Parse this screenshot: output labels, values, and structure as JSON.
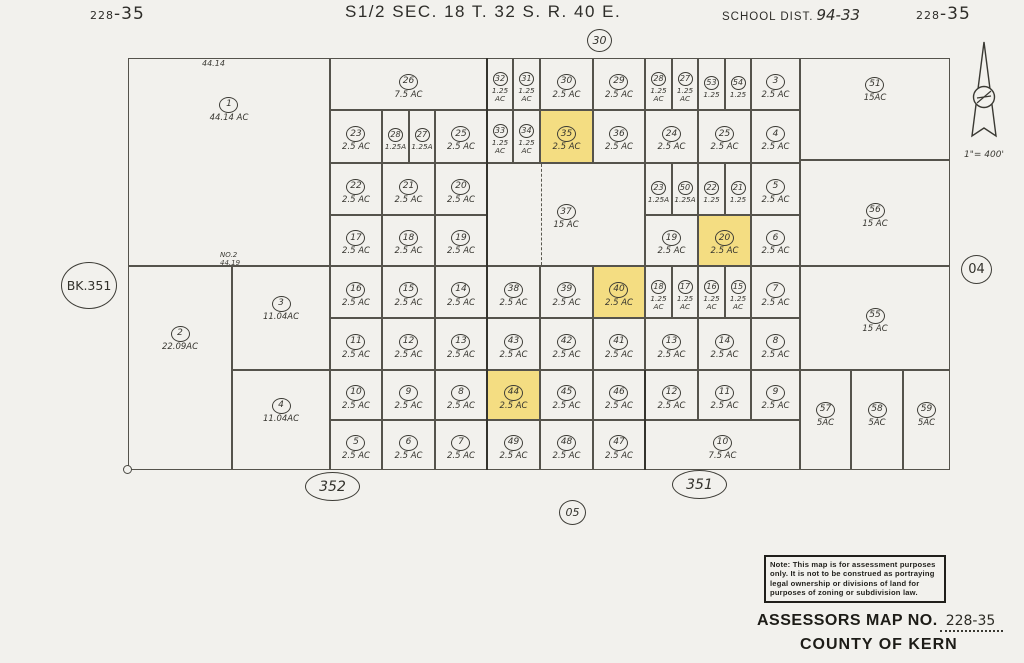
{
  "header": {
    "left_book": "228",
    "left_page": "-35",
    "title": "S1/2  SEC. 18  T. 32 S.  R. 40 E.",
    "school_label": "SCHOOL DIST.",
    "school_value": "94-33",
    "right_book": "228",
    "right_page": "-35"
  },
  "markers": {
    "section_top": "30",
    "section_bottom": "05",
    "section_right": "04",
    "book_left": "BK.351",
    "page_bottom_left": "352",
    "page_bottom_right": "351"
  },
  "edge_labels": {
    "top_dimension": "44.14",
    "road_name": "NO.2",
    "road_dimension": "44.19"
  },
  "scale_text": "1\"= 400'",
  "note_box": {
    "lines": [
      "Note: This map is for assessment purposes",
      "only. It is not to be construed as portraying",
      "legal ownership or divisions of land for",
      "purposes of zoning or subdivision law."
    ]
  },
  "footer": {
    "assessors_label": "ASSESSORS MAP NO.",
    "assessors_value": "228-35",
    "county": "COUNTY OF KERN"
  },
  "map": {
    "highlight_color": "#f4dd82",
    "parcels": [
      {
        "n": "1",
        "a": "44.14 AC",
        "x": 128,
        "y": 58,
        "w": 202,
        "h": 208,
        "dy": -55
      },
      {
        "n": "2",
        "a": "22.09AC",
        "x": 128,
        "y": 266,
        "w": 104,
        "h": 204,
        "dy": -32
      },
      {
        "n": "3",
        "a": "11.04AC",
        "x": 232,
        "y": 266,
        "w": 98,
        "h": 104,
        "dy": -12
      },
      {
        "n": "4",
        "a": "11.04AC",
        "x": 232,
        "y": 370,
        "w": 98,
        "h": 100,
        "dy": -12
      },
      {
        "n": "26",
        "a": "7.5 AC",
        "x": 330,
        "y": 58,
        "w": 157,
        "h": 52
      },
      {
        "n": "23",
        "a": "2.5 AC",
        "x": 330,
        "y": 110,
        "w": 52,
        "h": 53
      },
      {
        "n": "28",
        "a": "1.25A",
        "x": 382,
        "y": 110,
        "w": 27,
        "h": 53
      },
      {
        "n": "27",
        "a": "1.25A",
        "x": 409,
        "y": 110,
        "w": 26,
        "h": 53
      },
      {
        "n": "25",
        "a": "2.5 AC",
        "x": 435,
        "y": 110,
        "w": 52,
        "h": 53
      },
      {
        "n": "22",
        "a": "2.5 AC",
        "x": 330,
        "y": 163,
        "w": 52,
        "h": 52
      },
      {
        "n": "21",
        "a": "2.5 AC",
        "x": 382,
        "y": 163,
        "w": 53,
        "h": 52
      },
      {
        "n": "20",
        "a": "2.5 AC",
        "x": 435,
        "y": 163,
        "w": 52,
        "h": 52
      },
      {
        "n": "17",
        "a": "2.5 AC",
        "x": 330,
        "y": 215,
        "w": 52,
        "h": 51
      },
      {
        "n": "18",
        "a": "2.5 AC",
        "x": 382,
        "y": 215,
        "w": 53,
        "h": 51
      },
      {
        "n": "19",
        "a": "2.5 AC",
        "x": 435,
        "y": 215,
        "w": 52,
        "h": 51
      },
      {
        "n": "16",
        "a": "2.5 AC",
        "x": 330,
        "y": 266,
        "w": 52,
        "h": 52
      },
      {
        "n": "15",
        "a": "2.5 AC",
        "x": 382,
        "y": 266,
        "w": 53,
        "h": 52
      },
      {
        "n": "14",
        "a": "2.5 AC",
        "x": 435,
        "y": 266,
        "w": 52,
        "h": 52
      },
      {
        "n": "11",
        "a": "2.5 AC",
        "x": 330,
        "y": 318,
        "w": 52,
        "h": 52
      },
      {
        "n": "12",
        "a": "2.5 AC",
        "x": 382,
        "y": 318,
        "w": 53,
        "h": 52
      },
      {
        "n": "13",
        "a": "2.5 AC",
        "x": 435,
        "y": 318,
        "w": 52,
        "h": 52
      },
      {
        "n": "10",
        "a": "2.5 AC",
        "x": 330,
        "y": 370,
        "w": 52,
        "h": 50
      },
      {
        "n": "9",
        "a": "2.5 AC",
        "x": 382,
        "y": 370,
        "w": 53,
        "h": 50
      },
      {
        "n": "8",
        "a": "2.5 AC",
        "x": 435,
        "y": 370,
        "w": 52,
        "h": 50
      },
      {
        "n": "5",
        "a": "2.5 AC",
        "x": 330,
        "y": 420,
        "w": 52,
        "h": 50
      },
      {
        "n": "6",
        "a": "2.5 AC",
        "x": 382,
        "y": 420,
        "w": 53,
        "h": 50
      },
      {
        "n": "7",
        "a": "2.5 AC",
        "x": 435,
        "y": 420,
        "w": 52,
        "h": 50
      },
      {
        "n": "32",
        "a": "1.25\nAC",
        "x": 487,
        "y": 58,
        "w": 26,
        "h": 52
      },
      {
        "n": "31",
        "a": "1.25\nAC",
        "x": 513,
        "y": 58,
        "w": 27,
        "h": 52
      },
      {
        "n": "30",
        "a": "2.5 AC",
        "x": 540,
        "y": 58,
        "w": 53,
        "h": 52
      },
      {
        "n": "29",
        "a": "2.5 AC",
        "x": 593,
        "y": 58,
        "w": 52,
        "h": 52
      },
      {
        "n": "33",
        "a": "1.25\nAC",
        "x": 487,
        "y": 110,
        "w": 26,
        "h": 53
      },
      {
        "n": "34",
        "a": "1.25\nAC",
        "x": 513,
        "y": 110,
        "w": 27,
        "h": 53
      },
      {
        "n": "35",
        "a": "2.5 AC",
        "x": 540,
        "y": 110,
        "w": 53,
        "h": 53,
        "hl": true
      },
      {
        "n": "36",
        "a": "2.5 AC",
        "x": 593,
        "y": 110,
        "w": 52,
        "h": 53
      },
      {
        "n": "37",
        "a": "15 AC",
        "x": 487,
        "y": 163,
        "w": 158,
        "h": 103
      },
      {
        "n": "38",
        "a": "2.5 AC",
        "x": 487,
        "y": 266,
        "w": 53,
        "h": 52
      },
      {
        "n": "39",
        "a": "2.5 AC",
        "x": 540,
        "y": 266,
        "w": 53,
        "h": 52
      },
      {
        "n": "40",
        "a": "2.5 AC",
        "x": 593,
        "y": 266,
        "w": 52,
        "h": 52,
        "hl": true
      },
      {
        "n": "43",
        "a": "2.5 AC",
        "x": 487,
        "y": 318,
        "w": 53,
        "h": 52
      },
      {
        "n": "42",
        "a": "2.5 AC",
        "x": 540,
        "y": 318,
        "w": 53,
        "h": 52
      },
      {
        "n": "41",
        "a": "2.5 AC",
        "x": 593,
        "y": 318,
        "w": 52,
        "h": 52
      },
      {
        "n": "44",
        "a": "2.5 AC",
        "x": 487,
        "y": 370,
        "w": 53,
        "h": 50,
        "hl": true
      },
      {
        "n": "45",
        "a": "2.5 AC",
        "x": 540,
        "y": 370,
        "w": 53,
        "h": 50
      },
      {
        "n": "46",
        "a": "2.5 AC",
        "x": 593,
        "y": 370,
        "w": 52,
        "h": 50
      },
      {
        "n": "49",
        "a": "2.5 AC",
        "x": 487,
        "y": 420,
        "w": 53,
        "h": 50
      },
      {
        "n": "48",
        "a": "2.5 AC",
        "x": 540,
        "y": 420,
        "w": 53,
        "h": 50
      },
      {
        "n": "47",
        "a": "2.5 AC",
        "x": 593,
        "y": 420,
        "w": 52,
        "h": 50
      },
      {
        "n": "28",
        "a": "1.25\nAC",
        "x": 645,
        "y": 58,
        "w": 27,
        "h": 52
      },
      {
        "n": "27",
        "a": "1.25\nAC",
        "x": 672,
        "y": 58,
        "w": 26,
        "h": 52
      },
      {
        "n": "53",
        "a": "1.25",
        "x": 698,
        "y": 58,
        "w": 27,
        "h": 52
      },
      {
        "n": "54",
        "a": "1.25",
        "x": 725,
        "y": 58,
        "w": 26,
        "h": 52
      },
      {
        "n": "3",
        "a": "2.5 AC",
        "x": 751,
        "y": 58,
        "w": 49,
        "h": 52
      },
      {
        "n": "24",
        "a": "2.5 AC",
        "x": 645,
        "y": 110,
        "w": 53,
        "h": 53
      },
      {
        "n": "25",
        "a": "2.5 AC",
        "x": 698,
        "y": 110,
        "w": 53,
        "h": 53
      },
      {
        "n": "4",
        "a": "2.5 AC",
        "x": 751,
        "y": 110,
        "w": 49,
        "h": 53
      },
      {
        "n": "23",
        "a": "1.25A",
        "x": 645,
        "y": 163,
        "w": 27,
        "h": 52
      },
      {
        "n": "50",
        "a": "1.25A",
        "x": 672,
        "y": 163,
        "w": 26,
        "h": 52
      },
      {
        "n": "22",
        "a": "1.25",
        "x": 698,
        "y": 163,
        "w": 27,
        "h": 52
      },
      {
        "n": "21",
        "a": "1.25",
        "x": 725,
        "y": 163,
        "w": 26,
        "h": 52
      },
      {
        "n": "5",
        "a": "2.5 AC",
        "x": 751,
        "y": 163,
        "w": 49,
        "h": 52
      },
      {
        "n": "19",
        "a": "2.5 AC",
        "x": 645,
        "y": 215,
        "w": 53,
        "h": 51
      },
      {
        "n": "20",
        "a": "2.5 AC",
        "x": 698,
        "y": 215,
        "w": 53,
        "h": 51,
        "hl": true
      },
      {
        "n": "6",
        "a": "2.5 AC",
        "x": 751,
        "y": 215,
        "w": 49,
        "h": 51
      },
      {
        "n": "18",
        "a": "1.25\nAC",
        "x": 645,
        "y": 266,
        "w": 27,
        "h": 52
      },
      {
        "n": "17",
        "a": "1.25\nAC",
        "x": 672,
        "y": 266,
        "w": 26,
        "h": 52
      },
      {
        "n": "16",
        "a": "1.25\nAC",
        "x": 698,
        "y": 266,
        "w": 27,
        "h": 52
      },
      {
        "n": "15",
        "a": "1.25\nAC",
        "x": 725,
        "y": 266,
        "w": 26,
        "h": 52
      },
      {
        "n": "7",
        "a": "2.5 AC",
        "x": 751,
        "y": 266,
        "w": 49,
        "h": 52
      },
      {
        "n": "13",
        "a": "2.5 AC",
        "x": 645,
        "y": 318,
        "w": 53,
        "h": 52
      },
      {
        "n": "14",
        "a": "2.5 AC",
        "x": 698,
        "y": 318,
        "w": 53,
        "h": 52
      },
      {
        "n": "8",
        "a": "2.5 AC",
        "x": 751,
        "y": 318,
        "w": 49,
        "h": 52
      },
      {
        "n": "12",
        "a": "2.5 AC",
        "x": 645,
        "y": 370,
        "w": 53,
        "h": 50
      },
      {
        "n": "11",
        "a": "2.5 AC",
        "x": 698,
        "y": 370,
        "w": 53,
        "h": 50
      },
      {
        "n": "9",
        "a": "2.5 AC",
        "x": 751,
        "y": 370,
        "w": 49,
        "h": 50
      },
      {
        "n": "10",
        "a": "7.5 AC",
        "x": 645,
        "y": 420,
        "w": 155,
        "h": 50
      },
      {
        "n": "51",
        "a": "15AC",
        "x": 800,
        "y": 58,
        "w": 150,
        "h": 102,
        "dy": -22
      },
      {
        "n": "56",
        "a": "15 AC",
        "x": 800,
        "y": 160,
        "w": 150,
        "h": 106
      },
      {
        "n": "55",
        "a": "15 AC",
        "x": 800,
        "y": 266,
        "w": 150,
        "h": 104
      },
      {
        "n": "57",
        "a": "5AC",
        "x": 800,
        "y": 370,
        "w": 51,
        "h": 100,
        "dy": -8
      },
      {
        "n": "58",
        "a": "5AC",
        "x": 851,
        "y": 370,
        "w": 52,
        "h": 100,
        "dy": -8
      },
      {
        "n": "59",
        "a": "5AC",
        "x": 903,
        "y": 370,
        "w": 47,
        "h": 100,
        "dy": -8
      }
    ]
  }
}
